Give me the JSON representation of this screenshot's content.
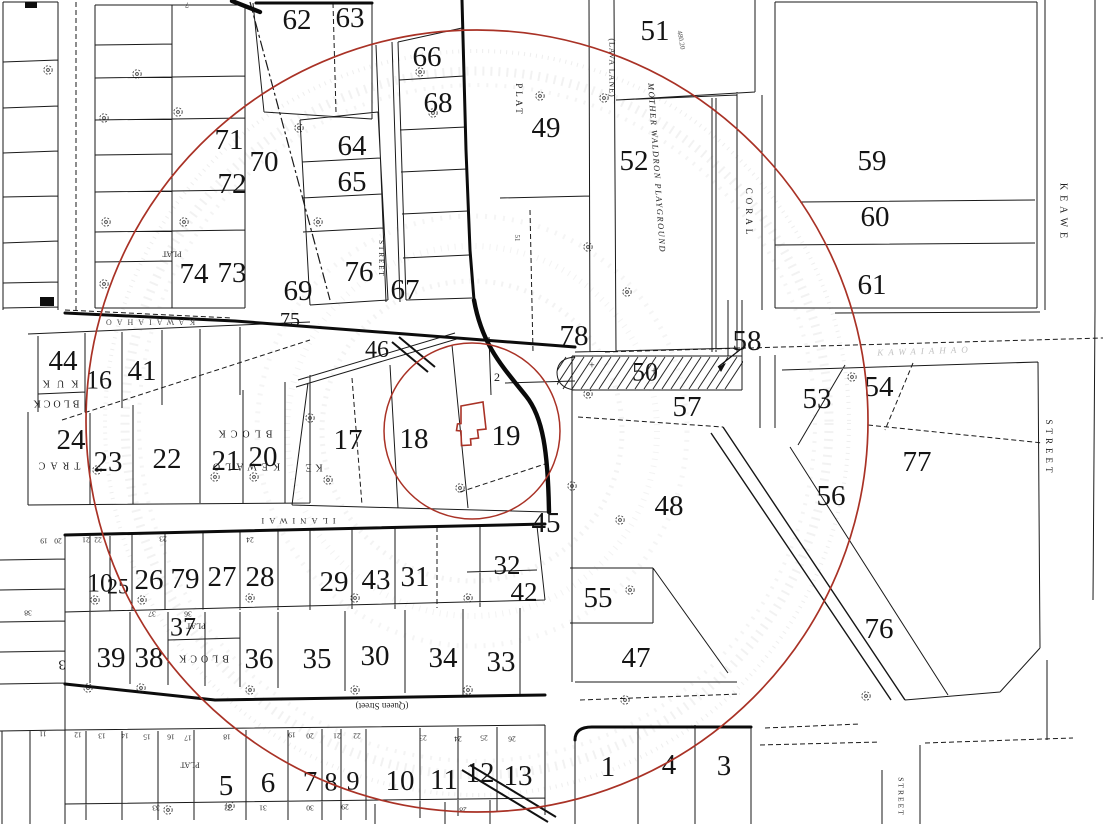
{
  "map": {
    "background": "#ffffff",
    "ink_color": "#161616",
    "red_color": "#a93226",
    "ghost_color": "#9a9a9a",
    "radius_circles": [
      {
        "cx": 477,
        "cy": 421,
        "r": 391
      },
      {
        "cx": 472,
        "cy": 431,
        "r": 88
      }
    ],
    "subject_parcel": {
      "points": "461,406 483,402 486,429 477.5,430 478.5,438 470.5,439 471,445 461.5,445.5 461,431 456.5,430.5 457.5,424 461,423.5"
    },
    "lot_numbers": [
      {
        "t": "62",
        "x": 297,
        "y": 20
      },
      {
        "t": "63",
        "x": 350,
        "y": 18
      },
      {
        "t": "66",
        "x": 427,
        "y": 57
      },
      {
        "t": "68",
        "x": 438,
        "y": 103
      },
      {
        "t": "64",
        "x": 352,
        "y": 146
      },
      {
        "t": "65",
        "x": 352,
        "y": 182
      },
      {
        "t": "71",
        "x": 229,
        "y": 140
      },
      {
        "t": "72",
        "x": 232,
        "y": 184
      },
      {
        "t": "70",
        "x": 264,
        "y": 162
      },
      {
        "t": "74",
        "x": 194,
        "y": 274
      },
      {
        "t": "73",
        "x": 232,
        "y": 273
      },
      {
        "t": "76",
        "x": 359,
        "y": 272
      },
      {
        "t": "67",
        "x": 405,
        "y": 290
      },
      {
        "t": "69",
        "x": 298,
        "y": 291
      },
      {
        "t": "49",
        "x": 546,
        "y": 128
      },
      {
        "t": "51",
        "x": 655,
        "y": 31
      },
      {
        "t": "52",
        "x": 634,
        "y": 161
      },
      {
        "t": "59",
        "x": 872,
        "y": 161
      },
      {
        "t": "60",
        "x": 875,
        "y": 217
      },
      {
        "t": "61",
        "x": 872,
        "y": 285
      },
      {
        "t": "75",
        "x": 290,
        "y": 320,
        "s": 20
      },
      {
        "t": "46",
        "x": 377,
        "y": 350,
        "s": 24
      },
      {
        "t": "78",
        "x": 574,
        "y": 336
      },
      {
        "t": "58",
        "x": 747,
        "y": 341
      },
      {
        "t": "50",
        "x": 645,
        "y": 372,
        "s": 26
      },
      {
        "t": "57",
        "x": 687,
        "y": 407
      },
      {
        "t": "53",
        "x": 817,
        "y": 399
      },
      {
        "t": "54",
        "x": 879,
        "y": 387
      },
      {
        "t": "44",
        "x": 63,
        "y": 361
      },
      {
        "t": "16",
        "x": 99,
        "y": 380,
        "s": 26
      },
      {
        "t": "41",
        "x": 142,
        "y": 371
      },
      {
        "t": "24",
        "x": 71,
        "y": 440
      },
      {
        "t": "23",
        "x": 108,
        "y": 462
      },
      {
        "t": "22",
        "x": 167,
        "y": 459
      },
      {
        "t": "21",
        "x": 226,
        "y": 461
      },
      {
        "t": "20",
        "x": 263,
        "y": 457
      },
      {
        "t": "17",
        "x": 348,
        "y": 440
      },
      {
        "t": "18",
        "x": 414,
        "y": 439
      },
      {
        "t": "19",
        "x": 506,
        "y": 436
      },
      {
        "t": "45",
        "x": 546,
        "y": 523
      },
      {
        "t": "48",
        "x": 669,
        "y": 506
      },
      {
        "t": "56",
        "x": 831,
        "y": 496
      },
      {
        "t": "77",
        "x": 917,
        "y": 462
      },
      {
        "t": "55",
        "x": 598,
        "y": 598
      },
      {
        "t": "47",
        "x": 636,
        "y": 658
      },
      {
        "t": "76",
        "x": 879,
        "y": 629
      },
      {
        "t": "42",
        "x": 524,
        "y": 592,
        "s": 27
      },
      {
        "t": "32",
        "x": 507,
        "y": 565,
        "s": 27
      },
      {
        "t": "10",
        "x": 100,
        "y": 583,
        "s": 26
      },
      {
        "t": "25",
        "x": 118,
        "y": 586,
        "s": 22
      },
      {
        "t": "26",
        "x": 149,
        "y": 580
      },
      {
        "t": "79",
        "x": 185,
        "y": 579
      },
      {
        "t": "27",
        "x": 222,
        "y": 577
      },
      {
        "t": "28",
        "x": 260,
        "y": 577
      },
      {
        "t": "29",
        "x": 334,
        "y": 582
      },
      {
        "t": "43",
        "x": 376,
        "y": 580
      },
      {
        "t": "31",
        "x": 415,
        "y": 577
      },
      {
        "t": "37",
        "x": 183,
        "y": 627,
        "s": 26
      },
      {
        "t": "39",
        "x": 111,
        "y": 658
      },
      {
        "t": "38",
        "x": 149,
        "y": 658
      },
      {
        "t": "36",
        "x": 259,
        "y": 659
      },
      {
        "t": "35",
        "x": 317,
        "y": 659
      },
      {
        "t": "30",
        "x": 375,
        "y": 656
      },
      {
        "t": "34",
        "x": 443,
        "y": 658
      },
      {
        "t": "33",
        "x": 501,
        "y": 662
      },
      {
        "t": "5",
        "x": 226,
        "y": 786
      },
      {
        "t": "6",
        "x": 268,
        "y": 783
      },
      {
        "t": "7",
        "x": 310,
        "y": 782
      },
      {
        "t": "8",
        "x": 331,
        "y": 782,
        "s": 26
      },
      {
        "t": "9",
        "x": 353,
        "y": 781,
        "s": 26
      },
      {
        "t": "10",
        "x": 400,
        "y": 781
      },
      {
        "t": "11",
        "x": 444,
        "y": 780
      },
      {
        "t": "12",
        "x": 480,
        "y": 773
      },
      {
        "t": "13",
        "x": 518,
        "y": 776
      },
      {
        "t": "1",
        "x": 608,
        "y": 767
      },
      {
        "t": "4",
        "x": 669,
        "y": 765
      },
      {
        "t": "3",
        "x": 724,
        "y": 766
      },
      {
        "t": "2",
        "x": 497,
        "y": 377,
        "s": 12
      },
      {
        "t": "3",
        "x": 62,
        "y": 664,
        "s": 14,
        "r": 180
      }
    ],
    "street_labels": [
      {
        "t": "PLAT",
        "x": 519,
        "y": 100,
        "r": 90,
        "s": 9,
        "sp": 3
      },
      {
        "t": "(LAVA LANE)",
        "x": 612,
        "y": 68,
        "r": 90,
        "s": 8,
        "sp": 1
      },
      {
        "t": "MOTHER WALDRON PLAYGROUND",
        "x": 657,
        "y": 168,
        "r": 86,
        "s": 8.5,
        "sp": 1.5,
        "i": true
      },
      {
        "t": "CORAL",
        "x": 749,
        "y": 213,
        "r": 90,
        "s": 9,
        "sp": 4
      },
      {
        "t": "KEAWE",
        "x": 1063,
        "y": 213,
        "r": 90,
        "s": 10,
        "sp": 5
      },
      {
        "t": "STREET",
        "x": 1049,
        "y": 448,
        "r": 90,
        "s": 9,
        "sp": 4
      },
      {
        "t": "STREET",
        "x": 381,
        "y": 259,
        "r": 90,
        "s": 7,
        "sp": 2
      },
      {
        "t": "STREET",
        "x": 901,
        "y": 797,
        "r": 90,
        "s": 7.5,
        "sp": 2
      },
      {
        "t": "(Queen Street)",
        "x": 382,
        "y": 706,
        "r": 180,
        "s": 9
      },
      {
        "t": "ILANIWAI",
        "x": 296,
        "y": 521,
        "r": 180,
        "s": 8.5,
        "sp": 5,
        "c": "#333333"
      },
      {
        "t": "KAWAIAHAO",
        "x": 148,
        "y": 322,
        "r": 180,
        "s": 8,
        "sp": 5,
        "c": "#4a4a4a"
      },
      {
        "t": "KAWAIAHAO",
        "x": 925,
        "y": 351,
        "r": -2,
        "s": 9,
        "sp": 5,
        "c": "#c2c2c2",
        "i": true
      },
      {
        "t": "KUK",
        "x": 57,
        "y": 383,
        "r": 180,
        "s": 10,
        "sp": 7
      },
      {
        "t": "BLOCK",
        "x": 55,
        "y": 403,
        "r": 180,
        "s": 10,
        "sp": 3
      },
      {
        "t": "TRAC",
        "x": 57,
        "y": 465,
        "r": 180,
        "s": 10,
        "sp": 5
      },
      {
        "t": "BLOCK",
        "x": 243,
        "y": 433,
        "r": 180,
        "s": 10,
        "sp": 5
      },
      {
        "t": "KEWALO",
        "x": 244,
        "y": 466,
        "r": 180,
        "s": 10,
        "sp": 5
      },
      {
        "t": "KE",
        "x": 312,
        "y": 467,
        "r": 180,
        "s": 10,
        "sp": 4
      },
      {
        "t": "PLAT",
        "x": 172,
        "y": 254,
        "r": 180,
        "s": 8
      },
      {
        "t": "PLAT",
        "x": 196,
        "y": 626,
        "r": 180,
        "s": 8
      },
      {
        "t": "BLOCK",
        "x": 202,
        "y": 658,
        "r": 180,
        "s": 10,
        "sp": 4
      },
      {
        "t": "PLAT",
        "x": 190,
        "y": 765,
        "r": 180,
        "s": 8
      },
      {
        "t": "480.20",
        "x": 681,
        "y": 40,
        "r": 80,
        "s": 7,
        "c": "#555555"
      },
      {
        "t": "51",
        "x": 517,
        "y": 238,
        "r": 90,
        "s": 7,
        "c": "#444444"
      },
      {
        "t": "+",
        "x": 592,
        "y": 366,
        "s": 10
      },
      {
        "t": "+",
        "x": 654,
        "y": 372,
        "s": 10
      }
    ],
    "small_numbers": [
      {
        "t": "11",
        "x": 43,
        "y": 734
      },
      {
        "t": "12",
        "x": 78,
        "y": 735
      },
      {
        "t": "13",
        "x": 102,
        "y": 736
      },
      {
        "t": "14",
        "x": 125,
        "y": 736
      },
      {
        "t": "15",
        "x": 147,
        "y": 737
      },
      {
        "t": "16",
        "x": 171,
        "y": 737
      },
      {
        "t": "17",
        "x": 188,
        "y": 738
      },
      {
        "t": "18",
        "x": 227,
        "y": 737
      },
      {
        "t": "19",
        "x": 292,
        "y": 735
      },
      {
        "t": "20",
        "x": 310,
        "y": 736
      },
      {
        "t": "21",
        "x": 337,
        "y": 736
      },
      {
        "t": "22",
        "x": 357,
        "y": 736
      },
      {
        "t": "23",
        "x": 423,
        "y": 738
      },
      {
        "t": "24",
        "x": 458,
        "y": 739
      },
      {
        "t": "25",
        "x": 484,
        "y": 738
      },
      {
        "t": "26",
        "x": 512,
        "y": 739
      },
      {
        "t": "29",
        "x": 345,
        "y": 807
      },
      {
        "t": "30",
        "x": 310,
        "y": 808
      },
      {
        "t": "31",
        "x": 263,
        "y": 808
      },
      {
        "t": "32",
        "x": 228,
        "y": 808
      },
      {
        "t": "33",
        "x": 156,
        "y": 808
      },
      {
        "t": "28",
        "x": 463,
        "y": 810
      },
      {
        "t": "19",
        "x": 44,
        "y": 541
      },
      {
        "t": "20",
        "x": 58,
        "y": 541
      },
      {
        "t": "21",
        "x": 86,
        "y": 540
      },
      {
        "t": "22",
        "x": 98,
        "y": 540
      },
      {
        "t": "23",
        "x": 163,
        "y": 539
      },
      {
        "t": "24",
        "x": 250,
        "y": 540
      },
      {
        "t": "38",
        "x": 28,
        "y": 613
      },
      {
        "t": "37",
        "x": 152,
        "y": 614
      },
      {
        "t": "36",
        "x": 188,
        "y": 614
      },
      {
        "t": "7",
        "x": 187,
        "y": 5
      }
    ],
    "symbols": {
      "survey_circles": [
        [
          137,
          74
        ],
        [
          104,
          118
        ],
        [
          178,
          112
        ],
        [
          48,
          70
        ],
        [
          106,
          222
        ],
        [
          184,
          222
        ],
        [
          104,
          284
        ],
        [
          420,
          72
        ],
        [
          433,
          113
        ],
        [
          540,
          96
        ],
        [
          588,
          247
        ],
        [
          604,
          98
        ],
        [
          627,
          292
        ],
        [
          299,
          128
        ],
        [
          318,
          222
        ],
        [
          97,
          470
        ],
        [
          215,
          477
        ],
        [
          254,
          477
        ],
        [
          310,
          418
        ],
        [
          328,
          480
        ],
        [
          460,
          488
        ],
        [
          572,
          486
        ],
        [
          588,
          394
        ],
        [
          620,
          520
        ],
        [
          95,
          600
        ],
        [
          142,
          600
        ],
        [
          250,
          598
        ],
        [
          355,
          598
        ],
        [
          468,
          598
        ],
        [
          630,
          590
        ],
        [
          88,
          688
        ],
        [
          141,
          688
        ],
        [
          250,
          690
        ],
        [
          355,
          690
        ],
        [
          468,
          690
        ],
        [
          168,
          810
        ],
        [
          230,
          806
        ],
        [
          625,
          700
        ],
        [
          866,
          696
        ],
        [
          852,
          377
        ]
      ]
    }
  }
}
